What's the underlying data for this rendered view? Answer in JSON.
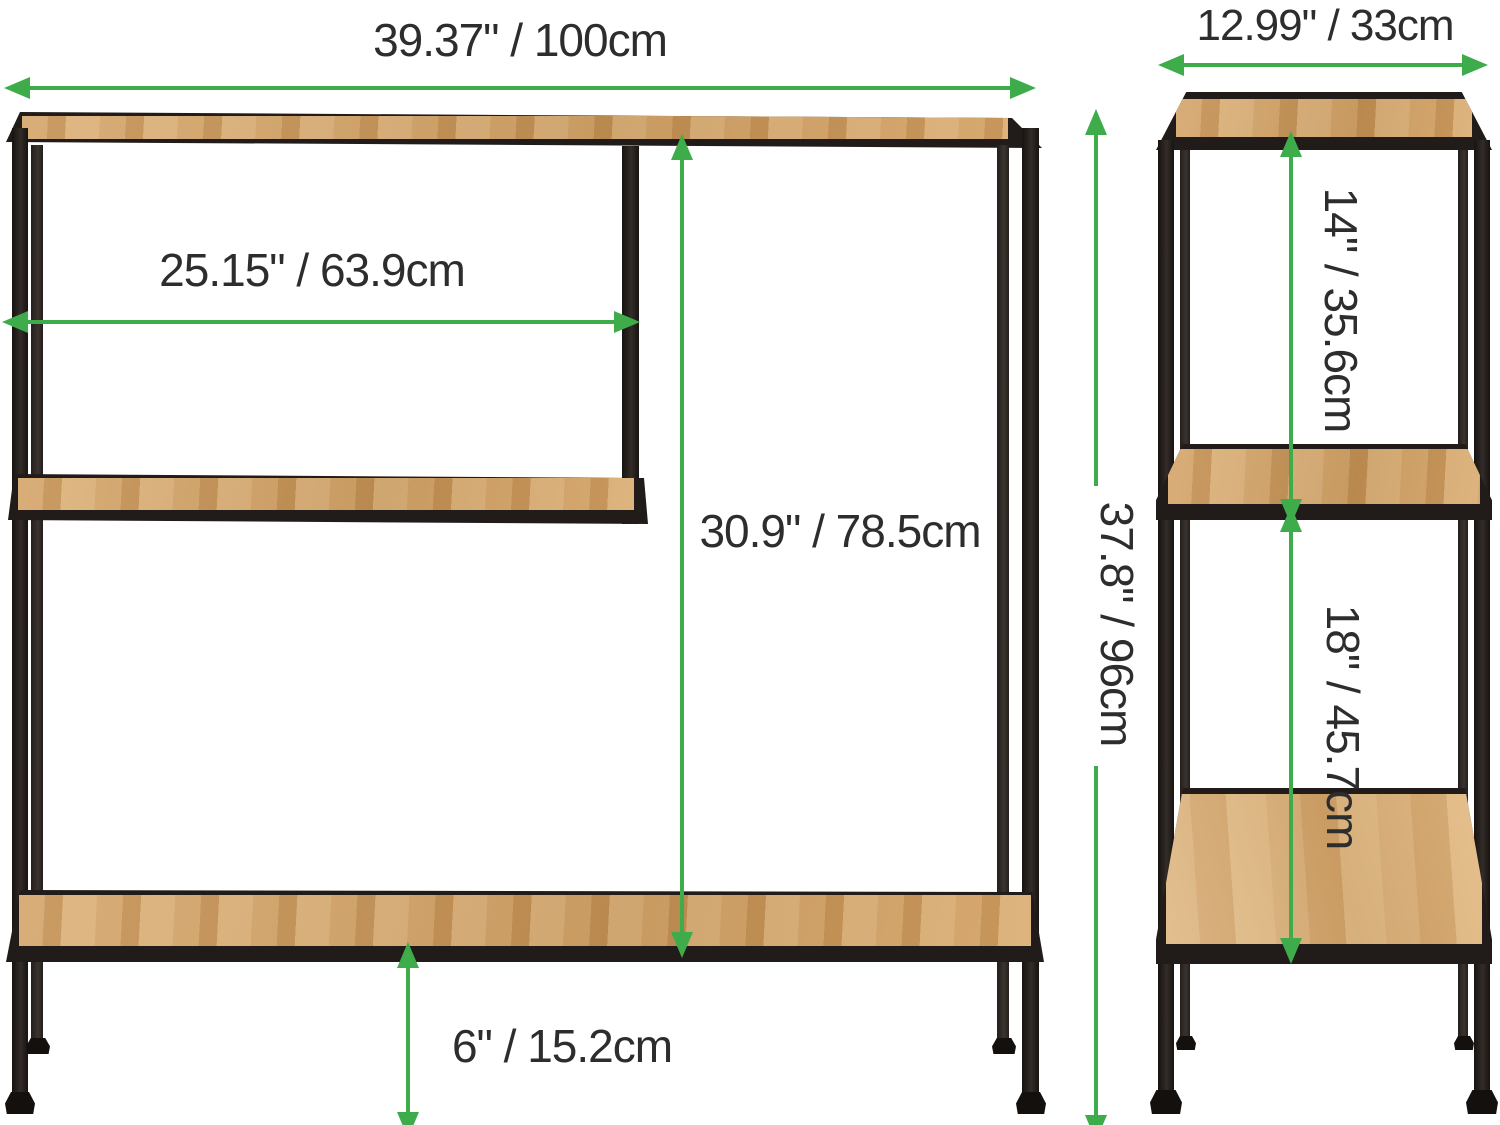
{
  "diagram_title": "Console table / shelf unit dimension diagram (front and side views)",
  "labels": {
    "front_width": "39.37\" / 100cm",
    "front_shelf_width": "25.15\" / 63.9cm",
    "front_open_height": "30.9\" / 78.5cm",
    "front_overall_height": "37.8\" / 96cm",
    "front_base_clearance": "6\" / 15.2cm",
    "side_depth": "12.99\" / 33cm",
    "side_upper_section": "14\" / 35.6cm",
    "side_lower_section": "18\" / 45.7cm"
  },
  "views": [
    {
      "name": "front-view",
      "dimension_labels": [
        "front_width",
        "front_shelf_width",
        "front_open_height",
        "front_overall_height",
        "front_base_clearance"
      ]
    },
    {
      "name": "side-view",
      "dimension_labels": [
        "side_depth",
        "side_upper_section",
        "side_lower_section"
      ]
    }
  ],
  "colors": {
    "dimension_green": "#3eac4a",
    "frame_black": "#211c1a",
    "wood_tan": "#cf9e63",
    "label_text": "#2d2d2d",
    "background": "#ffffff"
  }
}
